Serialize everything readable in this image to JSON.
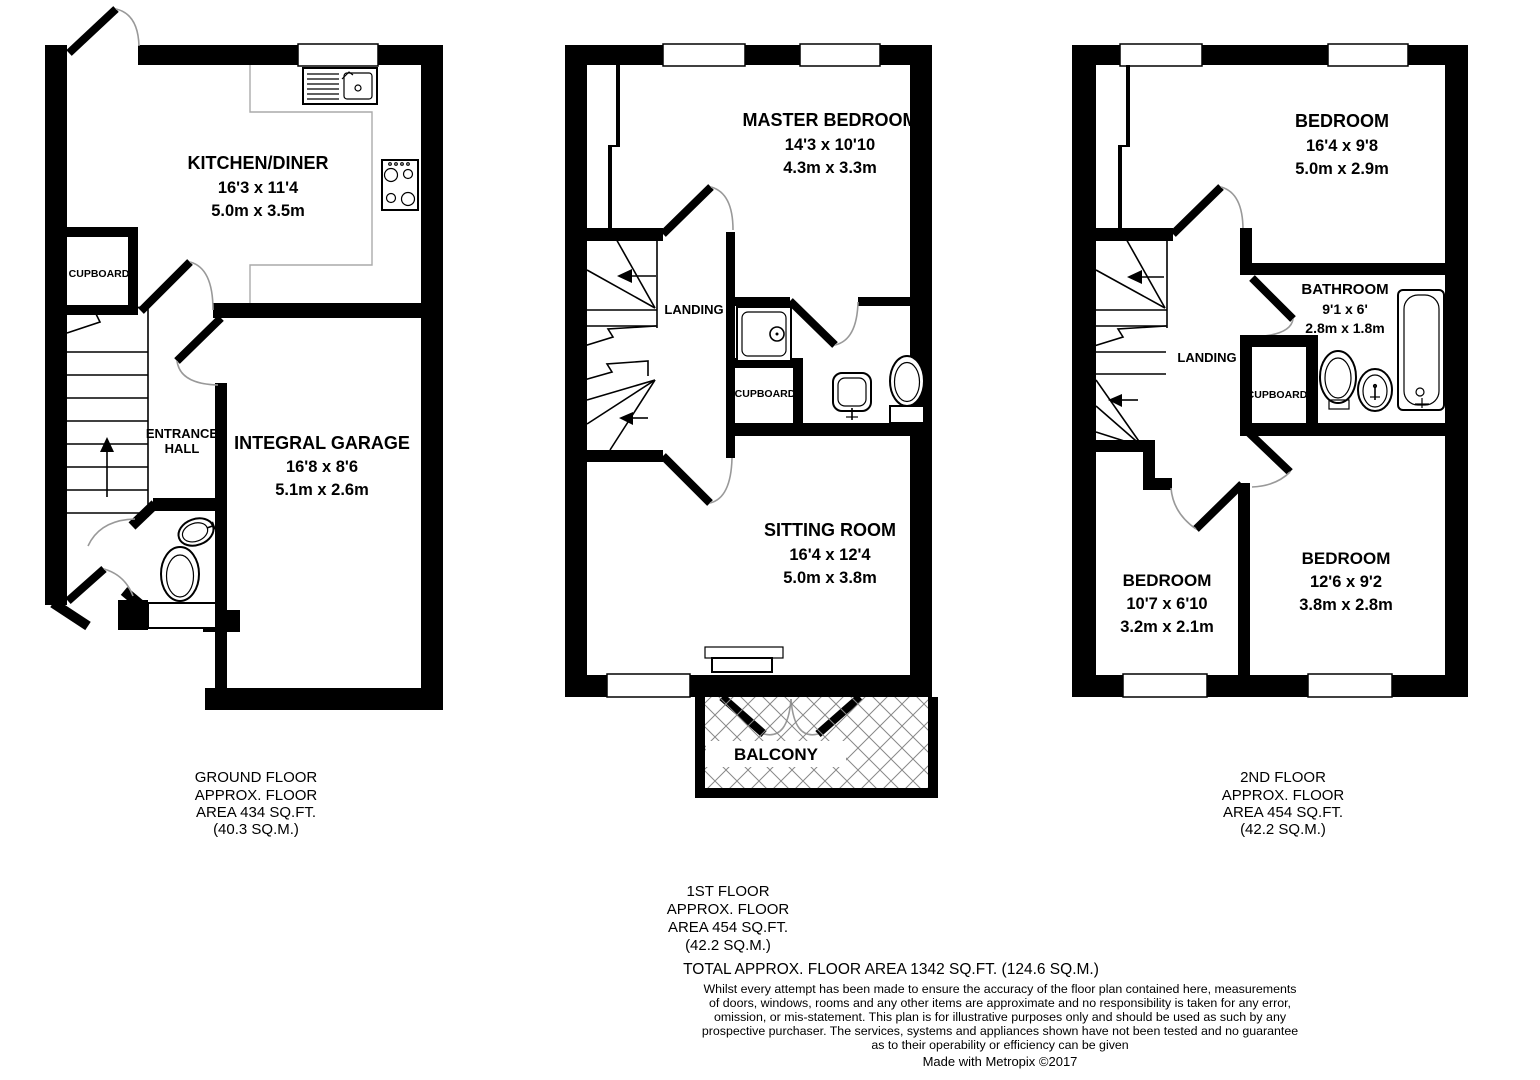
{
  "floors": {
    "ground": {
      "rooms": {
        "kitchen": {
          "name": "KITCHEN/DINER",
          "size_ft": "16'3 x 11'4",
          "size_m": "5.0m x 3.5m"
        },
        "cupboard": {
          "name": "CUPBOARD"
        },
        "entrance_hall": {
          "line1": "ENTRANCE",
          "line2": "HALL"
        },
        "garage": {
          "name": "INTEGRAL GARAGE",
          "size_ft": "16'8 x 8'6",
          "size_m": "5.1m x 2.6m"
        }
      },
      "caption": [
        "GROUND FLOOR",
        "APPROX. FLOOR",
        "AREA 434 SQ.FT.",
        "(40.3 SQ.M.)"
      ]
    },
    "first": {
      "rooms": {
        "master_bedroom": {
          "name": "MASTER BEDROOM",
          "size_ft": "14'3 x 10'10",
          "size_m": "4.3m x 3.3m"
        },
        "landing": {
          "name": "LANDING"
        },
        "cupboard": {
          "name": "CUPBOARD"
        },
        "sitting_room": {
          "name": "SITTING ROOM",
          "size_ft": "16'4 x 12'4",
          "size_m": "5.0m x 3.8m"
        },
        "balcony": {
          "name": "BALCONY"
        }
      },
      "caption": [
        "1ST FLOOR",
        "APPROX. FLOOR",
        "AREA 454 SQ.FT.",
        "(42.2 SQ.M.)"
      ]
    },
    "second": {
      "rooms": {
        "bedroom_top": {
          "name": "BEDROOM",
          "size_ft": "16'4 x 9'8",
          "size_m": "5.0m x 2.9m"
        },
        "bathroom": {
          "name": "BATHROOM",
          "size_ft": "9'1 x 6'",
          "size_m": "2.8m x 1.8m"
        },
        "landing": {
          "name": "LANDING"
        },
        "cupboard": {
          "name": "CUPBOARD"
        },
        "bedroom_left": {
          "name": "BEDROOM",
          "size_ft": "10'7 x 6'10",
          "size_m": "3.2m x 2.1m"
        },
        "bedroom_right": {
          "name": "BEDROOM",
          "size_ft": "12'6 x 9'2",
          "size_m": "3.8m x 2.8m"
        }
      },
      "caption": [
        "2ND FLOOR",
        "APPROX. FLOOR",
        "AREA 454 SQ.FT.",
        "(42.2 SQ.M.)"
      ]
    }
  },
  "summary": {
    "total": "TOTAL APPROX. FLOOR AREA 1342 SQ.FT. (124.6 SQ.M.)",
    "disclaimer": [
      "Whilst every attempt has been made to ensure the accuracy of the floor plan contained here, measurements",
      "of doors, windows, rooms and any other items are approximate and no responsibility is taken for any error,",
      "omission, or mis-statement. This plan is for illustrative purposes only and should be used as such by any",
      "prospective purchaser. The services, systems and appliances shown have not been tested and no guarantee",
      "as to their operability or efficiency can be given"
    ],
    "credit": "Made with Metropix ©2017"
  },
  "colors": {
    "wall": "#000000",
    "background": "#ffffff",
    "door_arc": "#999999",
    "counter_line": "#aaaaaa",
    "hatch": "#888888"
  }
}
